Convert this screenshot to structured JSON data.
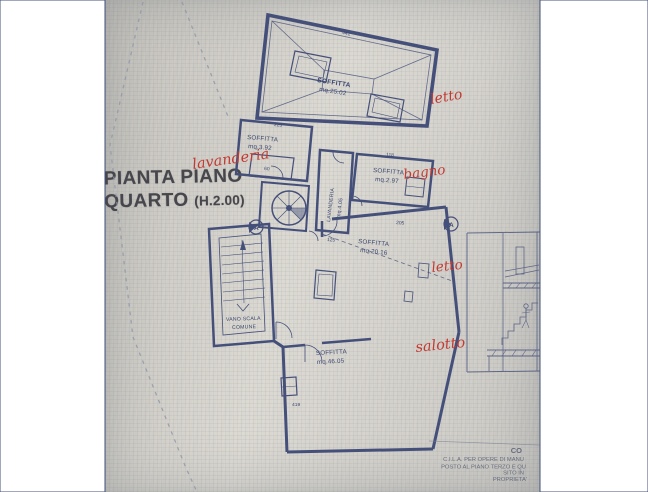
{
  "sheet": {
    "title_line1": "PIANTA PIANO",
    "title_line2": "QUARTO",
    "title_height_note": "(H.2.00)"
  },
  "rooms": {
    "attic_main": {
      "label": "SOFFITTA",
      "area": "mq.25.02"
    },
    "attic_left": {
      "label": "SOFFITTA",
      "area": "mq.3.92"
    },
    "laundry": {
      "label": "LAVANDERIA",
      "area": "mq.4.05"
    },
    "attic_right": {
      "label": "SOFFITTA",
      "area": "mq.2.97"
    },
    "attic_mid": {
      "label": "SOFFITTA",
      "area": "mq.20.16"
    },
    "stairwell": {
      "label_line1": "VANO SCALA",
      "label_line2": "COMUNE"
    },
    "attic_bottom": {
      "label": "SOFFITTA",
      "area": "mq.46.05"
    }
  },
  "dimensions": {
    "d441": "441",
    "d223": "223",
    "d60": "60",
    "d118": "118",
    "d125": "125",
    "d205": "205",
    "d419": "419"
  },
  "handwritten_notes": {
    "letto_top": "letto",
    "lavanderia": "lavanderia",
    "bagno": "bagno",
    "letto_mid": "letto",
    "salotto": "salotto"
  },
  "section_markers": {
    "a1": "A",
    "a2": "A"
  },
  "title_block": {
    "line1": "CO",
    "line2": "C.I.L.A. PER OPERE DI MANU",
    "line3": "POSTO AL PIANO TERZO E QU",
    "line4": "SITO IN",
    "line5": "PROPRIETA'"
  },
  "colors": {
    "ink": "#45507a",
    "red_ink": "#c23a32",
    "paper": "#d9d6ce"
  }
}
